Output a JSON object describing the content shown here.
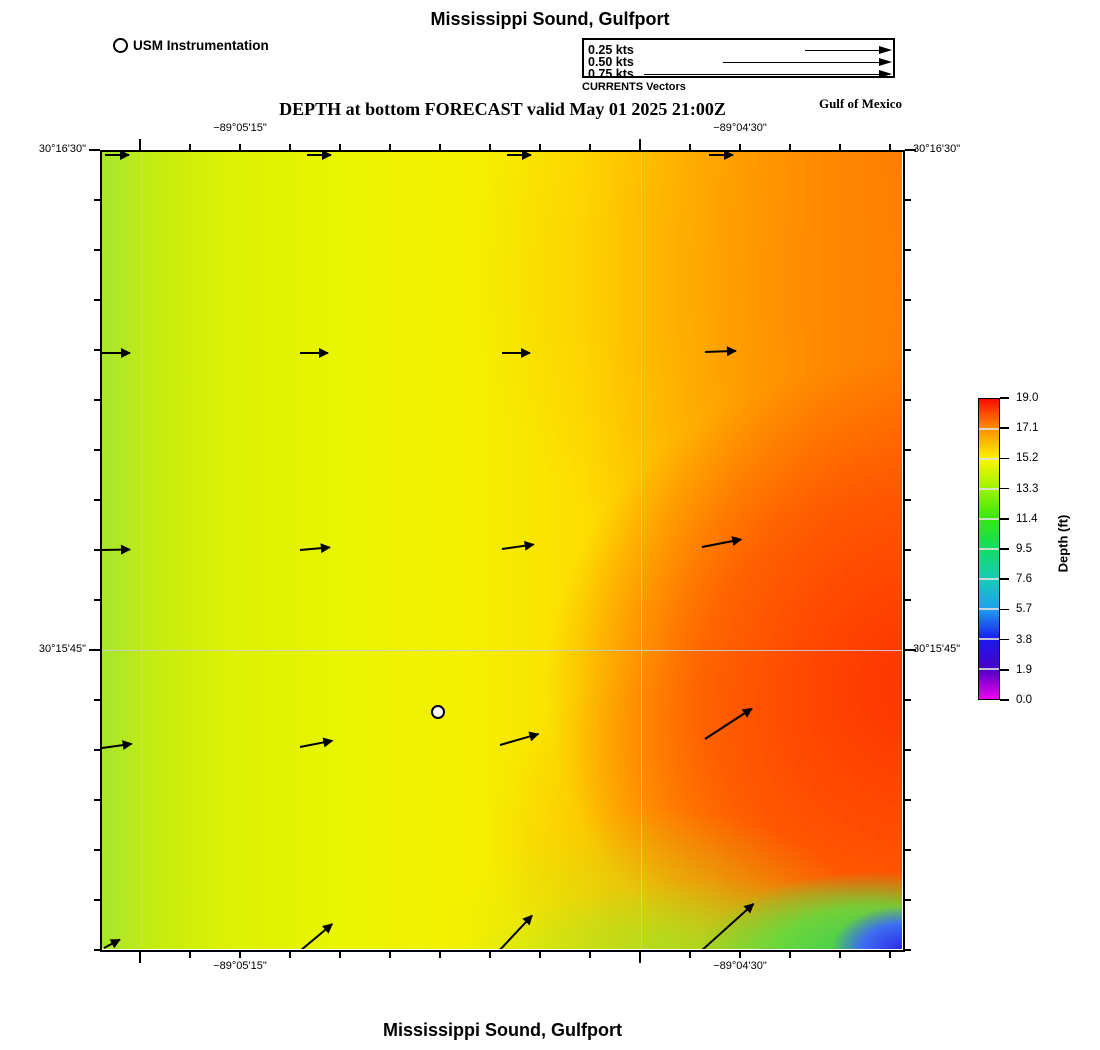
{
  "titles": {
    "top": "Mississippi Sound, Gulfport",
    "subtitle": "DEPTH at bottom FORECAST valid May 01 2025 21:00Z",
    "region": "Gulf of Mexico",
    "bottom": "Mississippi Sound, Gulfport"
  },
  "station_legend": {
    "label": "USM Instrumentation"
  },
  "vector_legend": {
    "caption": "CURRENTS Vectors",
    "x2": 306,
    "entries": [
      {
        "label": "0.25 kts",
        "x1": 221,
        "y": 10
      },
      {
        "label": "0.50 kts",
        "x1": 139,
        "y": 22
      },
      {
        "label": "0.75 kts",
        "x1": 60,
        "y": 34
      }
    ]
  },
  "axes": {
    "top": [
      {
        "text": "−89°05'15\"",
        "x": 140
      },
      {
        "text": "−89°04'30\"",
        "x": 640
      }
    ],
    "bottom": [
      {
        "text": "−89°05'15\"",
        "x": 140
      },
      {
        "text": "−89°04'30\"",
        "x": 640
      }
    ],
    "left": [
      {
        "text": "30°16'30\"",
        "y": 150
      },
      {
        "text": "30°15'45\"",
        "y": 650
      }
    ],
    "right": [
      {
        "text": "30°16'30\"",
        "y": 150
      },
      {
        "text": "30°15'45\"",
        "y": 650
      }
    ],
    "x_major": [
      40,
      540
    ],
    "x_range": [
      40,
      790
    ],
    "x_minor_step": 50,
    "y_major": [
      0,
      500
    ],
    "y_range": [
      0,
      800
    ],
    "y_minor_step": 50
  },
  "colorbar": {
    "label": "Depth (ft)",
    "tick_labels": [
      "19.0",
      "17.1",
      "15.2",
      "13.3",
      "11.4",
      "9.5",
      "7.6",
      "5.7",
      "3.8",
      "1.9",
      "0.0"
    ],
    "geometry": {
      "top": 398,
      "height": 302
    }
  },
  "chart_data": {
    "type": "heatmap",
    "title": "Mississippi Sound, Gulfport",
    "variable": "DEPTH at bottom",
    "valid": "May 01 2025 21:00Z",
    "region": "Gulf of Mexico",
    "x_axis": {
      "labels": [
        "−89°05'15\"",
        "−89°04'30\""
      ]
    },
    "y_axis": {
      "labels": [
        "30°16'30\"",
        "30°15'45\""
      ]
    },
    "colorbar": {
      "label": "Depth (ft)",
      "min": 0.0,
      "max": 19.0,
      "ticks": [
        19.0,
        17.1,
        15.2,
        13.3,
        11.4,
        9.5,
        7.6,
        5.7,
        3.8,
        1.9,
        0.0
      ]
    },
    "depth_field_ft": {
      "west_edge": 13.5,
      "west": 14.5,
      "center": 15.5,
      "east": 18.0,
      "east_mid_maximum": 19.0,
      "southeast_corner_minimum": 4.0,
      "description": "Depth increases from yellow-green (~14 ft) in the west through yellow (~15.5 ft) mid-basin to orange-red (~18-19 ft) in the east; a shallow green-blue patch (~4-8 ft) sits in the far southeast corner."
    },
    "station": {
      "name": "USM Instrumentation",
      "x": 336,
      "y": 560
    },
    "vectors_note": "Bottom currents flow generally eastward (~0.25 kts), strengthening and veering northeastward toward the south and east of the domain.",
    "vectors": [
      {
        "x": 3,
        "y": 2,
        "len": 24,
        "ang": 0
      },
      {
        "x": 205,
        "y": 2,
        "len": 24,
        "ang": 0
      },
      {
        "x": 405,
        "y": 2,
        "len": 24,
        "ang": 0
      },
      {
        "x": 607,
        "y": 2,
        "len": 24,
        "ang": 0
      },
      {
        "x": 0,
        "y": 200,
        "len": 28,
        "ang": 0
      },
      {
        "x": 198,
        "y": 200,
        "len": 28,
        "ang": 0
      },
      {
        "x": 400,
        "y": 200,
        "len": 28,
        "ang": 0
      },
      {
        "x": 603,
        "y": 199,
        "len": 31,
        "ang": -2
      },
      {
        "x": 0,
        "y": 397,
        "len": 28,
        "ang": -1
      },
      {
        "x": 198,
        "y": 397,
        "len": 30,
        "ang": -5
      },
      {
        "x": 400,
        "y": 396,
        "len": 32,
        "ang": -8
      },
      {
        "x": 600,
        "y": 394,
        "len": 40,
        "ang": -11
      },
      {
        "x": 0,
        "y": 595,
        "len": 30,
        "ang": -8
      },
      {
        "x": 198,
        "y": 594,
        "len": 33,
        "ang": -11
      },
      {
        "x": 398,
        "y": 592,
        "len": 40,
        "ang": -16
      },
      {
        "x": 603,
        "y": 586,
        "len": 56,
        "ang": -33
      },
      {
        "x": 2,
        "y": 795,
        "len": 18,
        "ang": -28
      },
      {
        "x": 198,
        "y": 798,
        "len": 42,
        "ang": -40
      },
      {
        "x": 396,
        "y": 799,
        "len": 50,
        "ang": -47
      },
      {
        "x": 598,
        "y": 799,
        "len": 72,
        "ang": -42
      }
    ]
  }
}
